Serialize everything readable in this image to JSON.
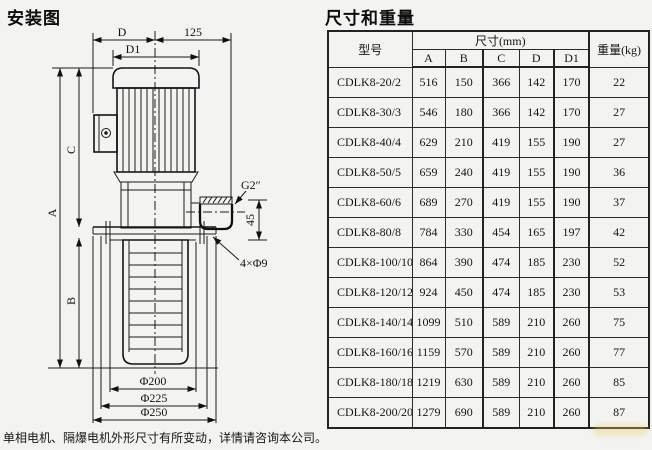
{
  "left": {
    "title": "安装图",
    "footnote": "单相电机、隔爆电机外形尺寸有所变动，详情请咨询本公司。"
  },
  "diagram": {
    "labels": {
      "d": "D",
      "offset125": "125",
      "d1": "D1",
      "a": "A",
      "b": "B",
      "c": "C",
      "outlet_thread": "G2″",
      "outlet_height": "45",
      "mounting_holes": "4×Φ9",
      "dia200": "Φ200",
      "dia225": "Φ225",
      "dia250": "Φ250"
    }
  },
  "table": {
    "title": "尺寸和重量",
    "header": {
      "model": "型号",
      "dims_group": "尺寸(mm)",
      "weight": "重量(kg)",
      "dim_cols": [
        "A",
        "B",
        "C",
        "D",
        "D1"
      ]
    },
    "rows": [
      {
        "model": "CDLK8-20/2",
        "A": 516,
        "B": 150,
        "C": 366,
        "D": 142,
        "D1": 170,
        "weight": 22
      },
      {
        "model": "CDLK8-30/3",
        "A": 546,
        "B": 180,
        "C": 366,
        "D": 142,
        "D1": 170,
        "weight": 27
      },
      {
        "model": "CDLK8-40/4",
        "A": 629,
        "B": 210,
        "C": 419,
        "D": 155,
        "D1": 190,
        "weight": 27
      },
      {
        "model": "CDLK8-50/5",
        "A": 659,
        "B": 240,
        "C": 419,
        "D": 155,
        "D1": 190,
        "weight": 36
      },
      {
        "model": "CDLK8-60/6",
        "A": 689,
        "B": 270,
        "C": 419,
        "D": 155,
        "D1": 190,
        "weight": 37
      },
      {
        "model": "CDLK8-80/8",
        "A": 784,
        "B": 330,
        "C": 454,
        "D": 165,
        "D1": 197,
        "weight": 42
      },
      {
        "model": "CDLK8-100/10",
        "A": 864,
        "B": 390,
        "C": 474,
        "D": 185,
        "D1": 230,
        "weight": 52
      },
      {
        "model": "CDLK8-120/12",
        "A": 924,
        "B": 450,
        "C": 474,
        "D": 185,
        "D1": 230,
        "weight": 53
      },
      {
        "model": "CDLK8-140/14",
        "A": 1099,
        "B": 510,
        "C": 589,
        "D": 210,
        "D1": 260,
        "weight": 75
      },
      {
        "model": "CDLK8-160/16",
        "A": 1159,
        "B": 570,
        "C": 589,
        "D": 210,
        "D1": 260,
        "weight": 77
      },
      {
        "model": "CDLK8-180/18",
        "A": 1219,
        "B": 630,
        "C": 589,
        "D": 210,
        "D1": 260,
        "weight": 85
      },
      {
        "model": "CDLK8-200/20",
        "A": 1279,
        "B": 690,
        "C": 589,
        "D": 210,
        "D1": 260,
        "weight": 87
      }
    ]
  }
}
